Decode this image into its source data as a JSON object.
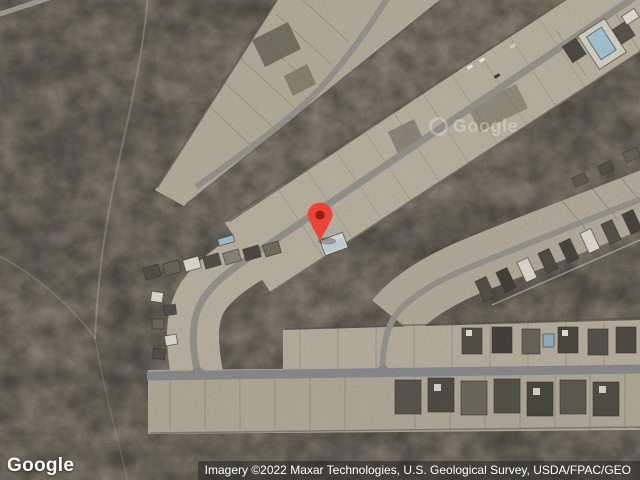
{
  "window": {
    "width": 640,
    "height": 480
  },
  "map": {
    "type": "satellite-imagery",
    "marker": {
      "name": "dropped-pin",
      "tip_x": 320,
      "tip_y": 242,
      "color": "#E94436",
      "dot_color": "#941D11"
    },
    "watermark": {
      "text": "Google"
    },
    "branding": {
      "logo_text": "Google"
    },
    "attribution": {
      "text": "Imagery ©2022 Maxar Technologies, U.S. Geological Survey, USDA/FPAC/GEO"
    },
    "icons": {
      "marker": "map-pin-icon",
      "watermark_ghost": "google-ghost-ring-icon"
    },
    "palette": {
      "desert": "#8A8375",
      "cleared_land": "#BBB3A2",
      "road": "#97968E",
      "road_major": "#8A8C8E",
      "roof_dark": "#54514A",
      "roof_light": "#DFDCD2",
      "pool_blue": "#A6C6D6"
    }
  }
}
